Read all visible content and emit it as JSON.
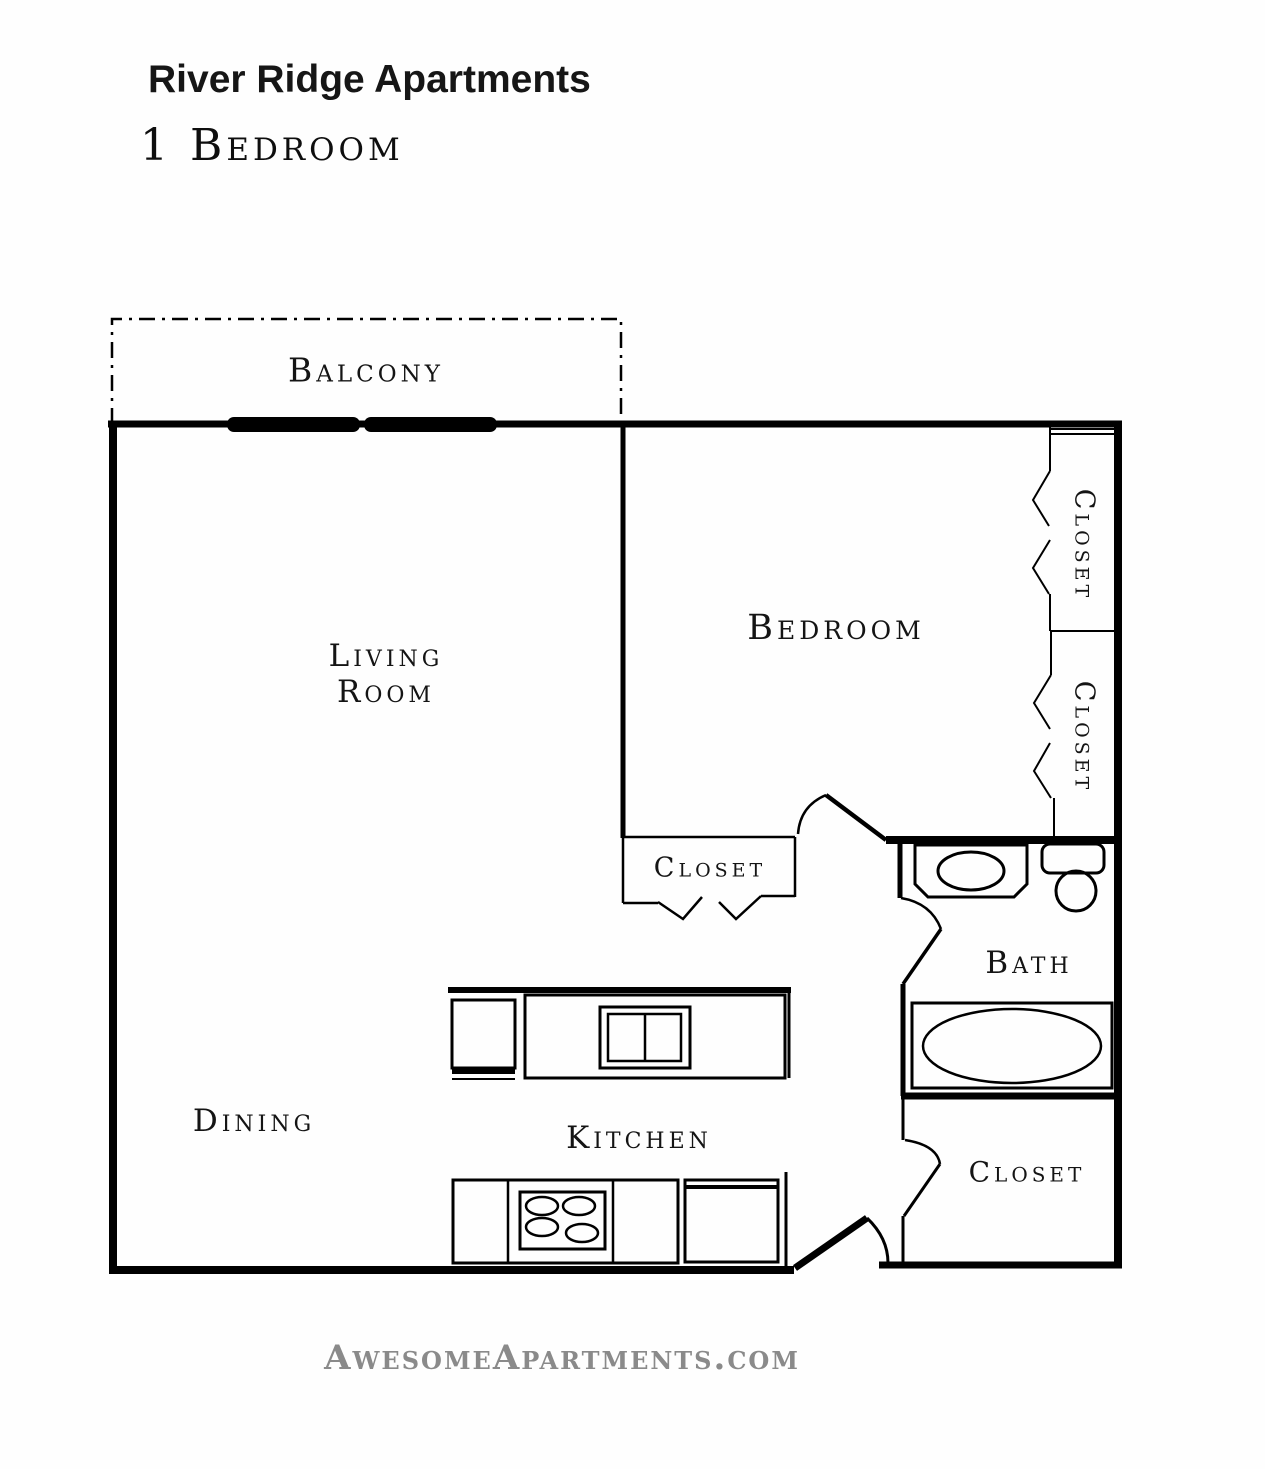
{
  "header": {
    "title": "River Ridge Apartments",
    "subtitle": "1 Bedroom"
  },
  "rooms": {
    "balcony": "Balcony",
    "living_room_line1": "Living",
    "living_room_line2": "Room",
    "bedroom": "Bedroom",
    "closet_top_right": "Closet",
    "closet_bottom_right": "Closet",
    "closet_bedroom": "Closet",
    "bath": "Bath",
    "dining": "Dining",
    "kitchen": "Kitchen",
    "closet_entry": "Closet"
  },
  "footer": {
    "website": "AwesomeApartments.com"
  },
  "colors": {
    "line": "#000000",
    "footer_text": "#8a8a8a"
  }
}
